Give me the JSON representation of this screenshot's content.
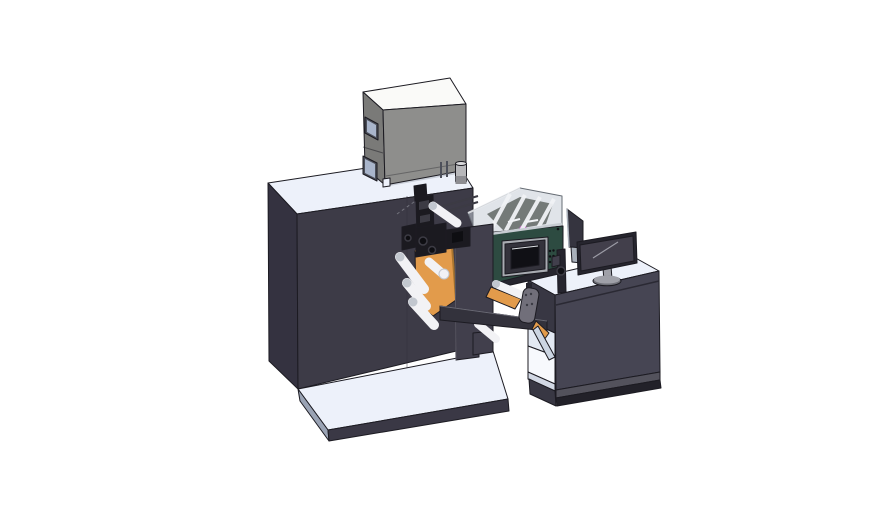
{
  "scene": {
    "description": "Isometric 3D CAD render of an industrial label printing and converting machine line with operator desk and monitor",
    "components": {
      "main_cabinet": "main machine cabinet",
      "base_platform": "machine base platform",
      "electrical_box": "gray electrical enclosure box",
      "unwind_unit": "orange unwind side plates with web rollers",
      "print_mechanism": "black print head mechanism",
      "front_plate": "front support plate",
      "hmi_unit": "teal control unit with HMI touch panel",
      "guard_cover": "transparent machine guard cover",
      "support_beam": "horizontal support beam",
      "hanging_bracket": "gray hanging bracket",
      "operator_desk": "operator desk with open shelf",
      "rear_monitor": "rear-facing monitor panel",
      "front_monitor": "desktop monitor on stand"
    }
  },
  "colors": {
    "bg": "#ffffff",
    "outline": "#1c1b22",
    "surface": "#edf1fa",
    "cabinetFront": "#3d3b47",
    "cabinetSide": "#343240",
    "seam": "#2f2d38",
    "dash": "#73737d",
    "platformFront": "#3a3845",
    "platformSide": "#9aa3b4",
    "boxTop": "#fafaf8",
    "boxFront": "#8e8e8c",
    "boxSide": "#7a7a78",
    "boxPanel": "#4d505a",
    "boxPanelGlass": "#a9b5cb",
    "boxContact": "#c9ced8",
    "cylinder": "#b7b7ba",
    "cylinderDark": "#8d8d92",
    "cylinderTop": "#d9d9db",
    "orange": "#e29b4b",
    "orangeDark": "#a9752f",
    "roller": "#f2f2f5",
    "rollerCap": "#c2c7cf",
    "mechanism": "#1b1a20",
    "mechanismLight": "#3c3b44",
    "mechDark": "#0e0e12",
    "plate": "#413f4c",
    "plateEdge": "#5c5a66",
    "railDark": "#26252e",
    "beam": "#33323c",
    "beamEdge": "#6a6a75",
    "teal": "#2d4b41",
    "tealSide": "#223b33",
    "tealTop": "#c7ccd2",
    "hmiFrame": "#a8abb1",
    "hmiBezel": "#34333c",
    "hmiScreen": "#101015",
    "screenHighlight": "#dfe2e6",
    "enclosureFill": "rgba(198,206,215,0.55)",
    "enclosureRib": "#f1f3f6",
    "enclosureEdge": "#666c74",
    "enclosureInner": "#3a403c",
    "magenta": "#c45ec9",
    "bracket": "#716f7a",
    "bracketDot": "#3b3b44",
    "panelBack": "#35343f",
    "panelLight": "#a9b0ba",
    "monitorBezel": "#26252e",
    "monitorScreen": "#423f4b",
    "monitorLine": "#9b9ba5",
    "standGray": "#9fa0a8",
    "standDark": "#6f7078",
    "deskFront": "#464553",
    "deskLeft": "#383743",
    "deskSeam": "#2a2933",
    "baseMid": "#53525c",
    "baseDark": "#222129",
    "interiorWall": "#e3e9f3",
    "interiorFloor": "#f7f9fd",
    "interiorEdge": "#d2d8e4",
    "chute": "#ccd5e2"
  }
}
